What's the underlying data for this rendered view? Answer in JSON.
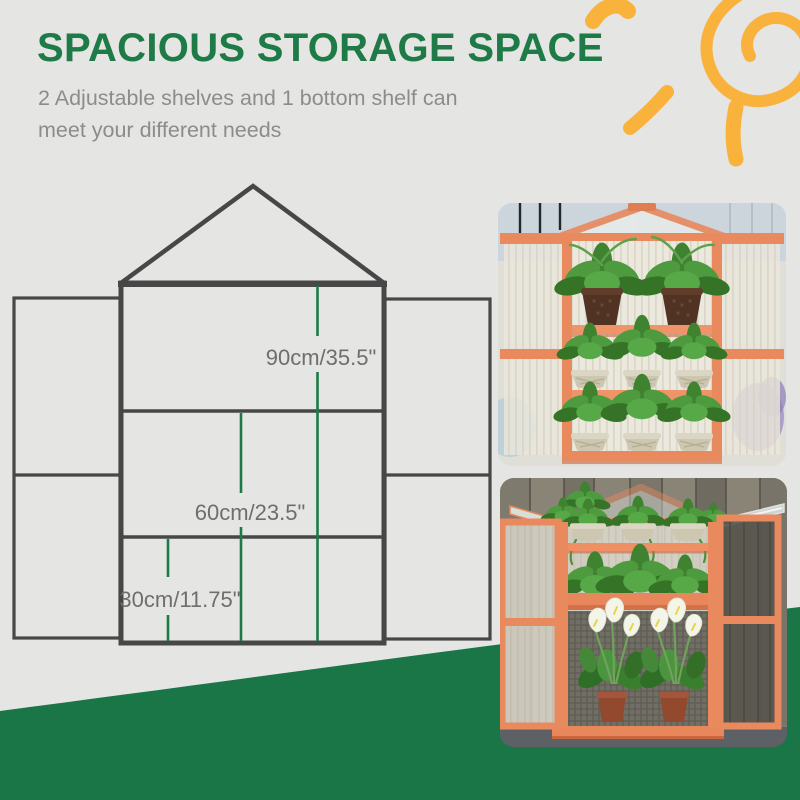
{
  "banner": {
    "title": "SPACIOUS STORAGE SPACE",
    "subtitle_line1": "2 Adjustable shelves and 1 bottom shelf can",
    "subtitle_line2": "meet your different needs"
  },
  "diagram": {
    "labels": [
      {
        "id": "top-section-height",
        "text": "90cm/35.5\""
      },
      {
        "id": "middle-section-height",
        "text": "60cm/23.5\""
      },
      {
        "id": "bottom-section-height",
        "text": "30cm/11.75\""
      }
    ]
  },
  "photos": [
    {
      "id": "photo-top",
      "alt": "Wooden cold frame greenhouse, closed, three shelves of potted green plants"
    },
    {
      "id": "photo-bottom",
      "alt": "Wooden cold frame greenhouse with lid and doors open, white calla lilies inside"
    }
  ],
  "palette": {
    "title_green": "#1E7B47",
    "wave_green": "#1A7647",
    "sun_yellow": "#F9B23B",
    "wood_orange": "#E9895E",
    "diagram_line": "#474747",
    "measure_green": "#1B7B47",
    "label_gray": "#6E6E6E",
    "subtitle_gray": "#8C8C8C",
    "background_gray": "#E5E5E3"
  }
}
